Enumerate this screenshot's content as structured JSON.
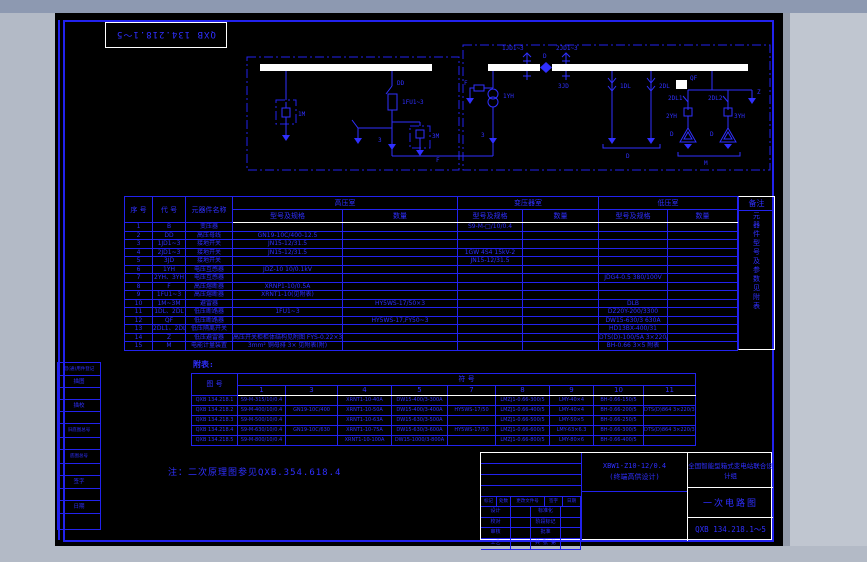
{
  "window": {
    "doc_no_inverted": "QXB 134.218.1～5"
  },
  "schematic": {
    "labels": {
      "dd": "DD",
      "fu1": "1FU1~3",
      "m1": "1M",
      "m3": "3M",
      "f_box": "F",
      "n3_left": "3",
      "jd1": "1JD1~3",
      "jd2": "2JD1~3",
      "jd3": "3JD",
      "d_bus": "D",
      "f_pt": "F",
      "yh1": "1YH",
      "n3_right": "3",
      "dl1": "1DL",
      "dl2": "2DL",
      "d_feeder": "D",
      "qf": "QF",
      "z": "Z",
      "dl21": "2DL1",
      "dl22": "2DL2",
      "yh2": "2YH",
      "yh3": "3YH",
      "d_a": "D",
      "d_b": "D",
      "m_bottom": "M"
    }
  },
  "main_table": {
    "col_no": "序  号",
    "col_code": "代  号",
    "col_name": "元器件名称",
    "sec_hv": "高压室",
    "sec_tr": "变压器室",
    "sec_lv": "低压室",
    "sec_remark": "备注",
    "sub_model": "型号及规格",
    "sub_qty": "数量",
    "remark_vertical": "元器件型号及参数见附表",
    "rows": [
      [
        "1",
        "B",
        "变压器",
        "",
        "",
        "S9-M-□/10/0.4",
        "",
        "",
        ""
      ],
      [
        "2",
        "DD",
        "高压母线",
        "GN19-10C/400-12.5",
        "",
        "",
        "",
        "",
        ""
      ],
      [
        "3",
        "1JD1~3",
        "接地开关",
        "JN15-12/31.5",
        "",
        "",
        "",
        "",
        ""
      ],
      [
        "4",
        "2JD1~3",
        "接地开关",
        "JN15-12/31.5",
        "",
        "1GW  4S4  15kV-2",
        "",
        "",
        ""
      ],
      [
        "5",
        "3JD",
        "接地开关",
        "",
        "",
        "JN15-12/31.5",
        "",
        "",
        ""
      ],
      [
        "6",
        "1YH",
        "电压互感器",
        "JDZ-10  10/0.1kV",
        "",
        "",
        "",
        "",
        ""
      ],
      [
        "7",
        "2YH、3YH",
        "电压互感器",
        "",
        "",
        "",
        "",
        "JDG4-0.5  380/100V",
        ""
      ],
      [
        "8",
        "F",
        "高压熔断器",
        "XRNP1-10/0.5A",
        "",
        "",
        "",
        "",
        ""
      ],
      [
        "9",
        "1FU1~3",
        "高压熔断器",
        "XRNT1-10(见附表)",
        "",
        "",
        "",
        "",
        ""
      ],
      [
        "10",
        "1M~3M",
        "避雷器",
        "",
        "HY5WS-17/50×3",
        "",
        "",
        "DLB",
        ""
      ],
      [
        "11",
        "1DL、2DL",
        "低压断路器",
        "1FU1~3",
        "",
        "",
        "",
        "DZ20Y-200/3300",
        ""
      ],
      [
        "12",
        "QF",
        "低压断路器",
        "",
        "HY5WS-17,FY50~3",
        "",
        "",
        "DW15-630/3  630A",
        ""
      ],
      [
        "13",
        "2DL1、2DL2",
        "低压隔离开关",
        "",
        "",
        "",
        "",
        "HD13BX-400/31",
        ""
      ],
      [
        "14",
        "Z",
        "低压避雷器",
        "高压开关柜柜体结构见附图  FYS-0.22×3",
        "",
        "",
        "",
        "DTS(D)-100/5A  3×220/380V",
        ""
      ],
      [
        "15",
        "M",
        "电能计量装置",
        "3mm² 铜母排  3× 见附表(附)",
        "",
        "",
        "",
        "BH-0.66  3×5  附表",
        ""
      ]
    ]
  },
  "attached_table": {
    "label": "附表:",
    "doc_col": "图  号",
    "sym_col": "符          号",
    "col_numbers": [
      "1",
      "3",
      "4",
      "5",
      "7",
      "8",
      "9",
      "10",
      "11"
    ],
    "rows": [
      [
        "QXB 134.218.1",
        "S9-M-315/10/0.4",
        "",
        "XRNT1-10-40A",
        "DW15-400/3-300A",
        "",
        "LMZJ1-0.66-300/5",
        "LMY-40×4",
        "BH-0.66-150/5",
        ""
      ],
      [
        "QXB 134.218.2",
        "S9-M-400/10/0.4",
        "GN19-10C/400",
        "XRNT1-10-50A",
        "DW15-400/3-400A",
        "HY5WS-17/50",
        "LMZJ1-0.66-400/5",
        "LMY-40×4",
        "BH-0.66-200/5",
        "DTS(D)864  3×220/380V"
      ],
      [
        "QXB 134.218.3",
        "S9-M-500/10/0.4",
        "",
        "XRNT1-10-63A",
        "DW15-630/3-500A",
        "",
        "LMZJ1-0.66-500/5",
        "LMY-50×5",
        "BH-0.66-250/5",
        ""
      ],
      [
        "QXB 134.218.4",
        "S9-M-630/10/0.4",
        "GN19-10C/630",
        "XRNT1-10-75A",
        "DW15-630/3-600A",
        "HY5WS-17/50",
        "LMZJ1-0.66-600/5",
        "LMY-63×6.3",
        "BH-0.66-300/5",
        "DTS(D)864  3×220/380V"
      ],
      [
        "QXB 134.218.5",
        "S9-M-800/10/0.4",
        "",
        "XRNT1-10-100A",
        "DW15-1000/3-800A",
        "",
        "LMZJ1-0.66-800/5",
        "LMY-80×6",
        "BH-0.66-400/5",
        ""
      ]
    ]
  },
  "note": "注：二次原理图参见QXB.354.618.4",
  "left_margin": {
    "items": [
      "借(通)用件登记",
      "描图",
      "描校",
      "旧底图总号",
      "底图总号",
      "签字",
      "日期"
    ]
  },
  "title_block": {
    "product_model": "XBW1-Z10-12/0.4",
    "product_sub": "(终端高供设计)",
    "org": "全国智能型箱式变电站联合设计组",
    "drawing_title": "一次电路图",
    "drawing_no": "QXB 134.218.1～5",
    "rev_headers": [
      "标记",
      "处数",
      "更改文件号",
      "签字",
      "日期"
    ],
    "sign_labels": {
      "design": "设计",
      "check": "校对",
      "audit": "审核",
      "craft": "工艺",
      "standard": "标准化",
      "approve": "批准",
      "stage": "阶段标记",
      "sheets": "共 张 第 张"
    }
  }
}
